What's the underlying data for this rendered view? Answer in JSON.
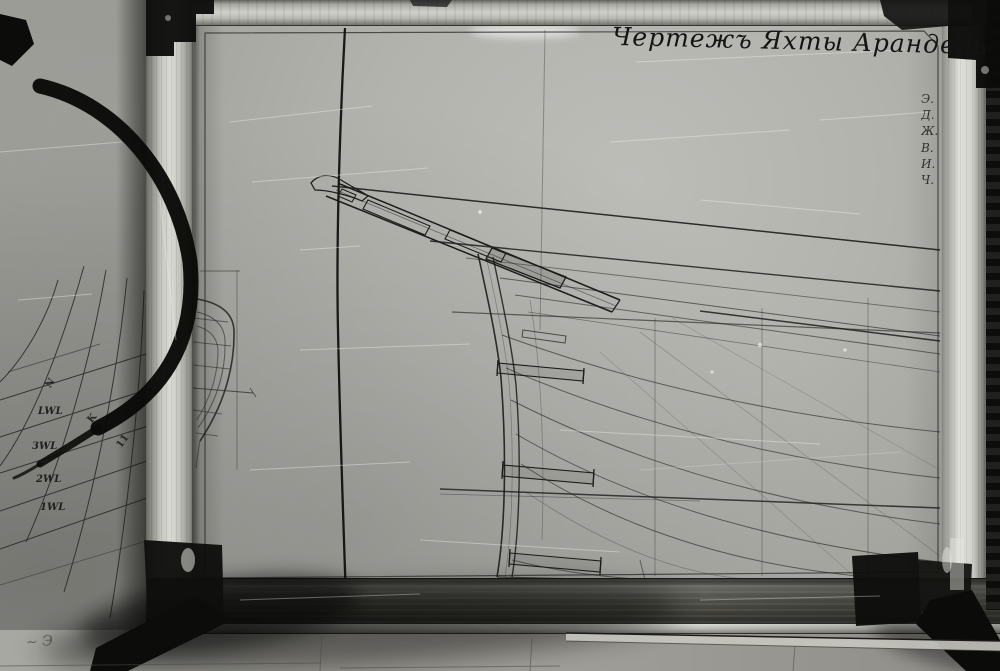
{
  "board": {
    "title": "Чертежъ Яхты Арандель",
    "margin_notes": [
      "Э.",
      "Д.",
      "Ж.",
      "В.",
      "И.",
      "Ч."
    ],
    "waterline_labels": [
      "LWL",
      "3WL",
      "2WL",
      "1WL"
    ],
    "grid_marks": [
      "N",
      "K",
      "11"
    ],
    "corner_scribble": "~ Э",
    "colors": {
      "paper": "#b3b3ae",
      "wall": "#8d8d88",
      "frame_light": "#d0d0ca",
      "ink": "#1c1c1c",
      "clamp": "#0f0f0d"
    }
  }
}
